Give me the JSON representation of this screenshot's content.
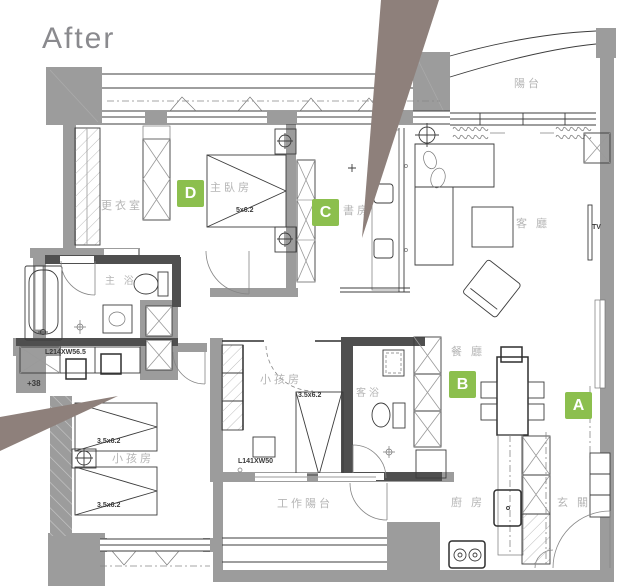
{
  "title": "After",
  "colors": {
    "wall_gray": "#9c9c9c",
    "dark_wall": "#4f4f4f",
    "badge_green": "#8cbf4e",
    "arrow_taupe": "#8e807b",
    "label_gray": "#b5b5b5",
    "dim_color": "#3a3a3a",
    "title_gray": "#8a8a8e"
  },
  "badges": [
    {
      "label": "A"
    },
    {
      "label": "B"
    },
    {
      "label": "C"
    },
    {
      "label": "D"
    }
  ],
  "rooms": {
    "balcony": "陽台",
    "living": "客 廳",
    "study": "書房",
    "master_bedroom": "主臥房",
    "dressing": "更衣室",
    "master_bath": "主 浴",
    "kids1": "小孩房",
    "kids2": "小孩房",
    "guest_bath": "客浴",
    "dining": "餐 廳",
    "kitchen": "廚 房",
    "entry": "玄 關",
    "work_balcony": "工作陽台"
  },
  "annotations": {
    "tv": "TV",
    "master_bed_dim": "5x6.2",
    "kid_bed_dim_1": "3.5x6.2",
    "kid_bed_dim_2": "3.5x6.2",
    "kid_bed_dim_3": "3.5x6.2",
    "vanity_dim": "L214XW56.5",
    "desk_dim": "L141XW50",
    "floor_level": "+38"
  }
}
